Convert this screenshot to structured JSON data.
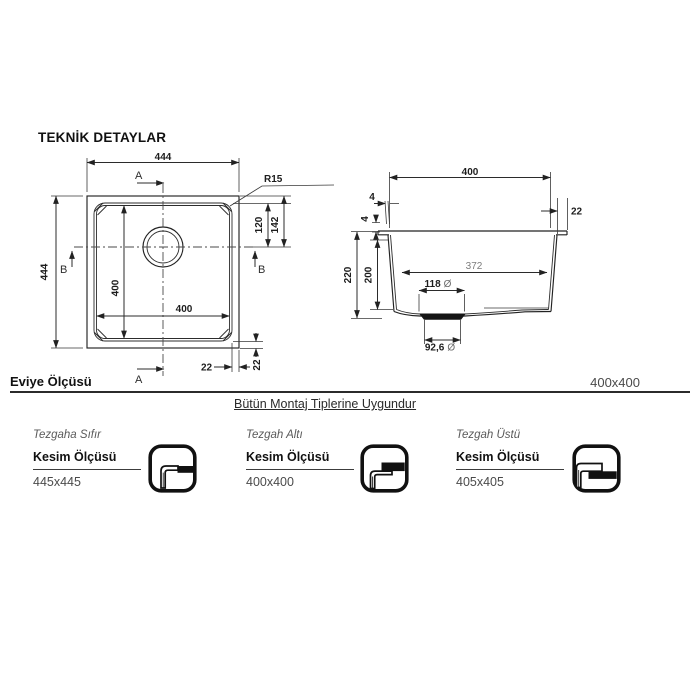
{
  "header": {
    "title": "TEKNİK DETAYLAR"
  },
  "colors": {
    "line": "#2b2b2b",
    "icon_black": "#111111",
    "dim_gray": "#7d7d7d"
  },
  "top_view": {
    "width": "444",
    "height": "444",
    "inner_width": "400",
    "inner_height": "400",
    "drain_offset_inner": "120",
    "drain_offset_outer": "142",
    "rim_w": "22",
    "rim_h": "22",
    "radius": "R15",
    "section_a": "A",
    "section_b": "B"
  },
  "section_view": {
    "top_width": "400",
    "inner_width": "372",
    "wall": "4",
    "flange": "4",
    "rim": "22",
    "inner_depth": "200",
    "total_depth": "220",
    "recess_d": "118",
    "hole_d": "92,6",
    "dia": "Ø"
  },
  "summary": {
    "label": "Eviye Ölçüsü",
    "value": "400x400"
  },
  "note": {
    "text": "Bütün Montaj Tiplerine Uygundur"
  },
  "mounts": [
    {
      "type_label": "Tezgaha Sıfır",
      "cut_label": "Kesim Ölçüsü",
      "cut_size": "445x445",
      "icon": "flush-mount-icon"
    },
    {
      "type_label": "Tezgah Altı",
      "cut_label": "Kesim Ölçüsü",
      "cut_size": "400x400",
      "icon": "under-mount-icon"
    },
    {
      "type_label": "Tezgah Üstü",
      "cut_label": "Kesim Ölçüsü",
      "cut_size": "405x405",
      "icon": "top-mount-icon"
    }
  ]
}
